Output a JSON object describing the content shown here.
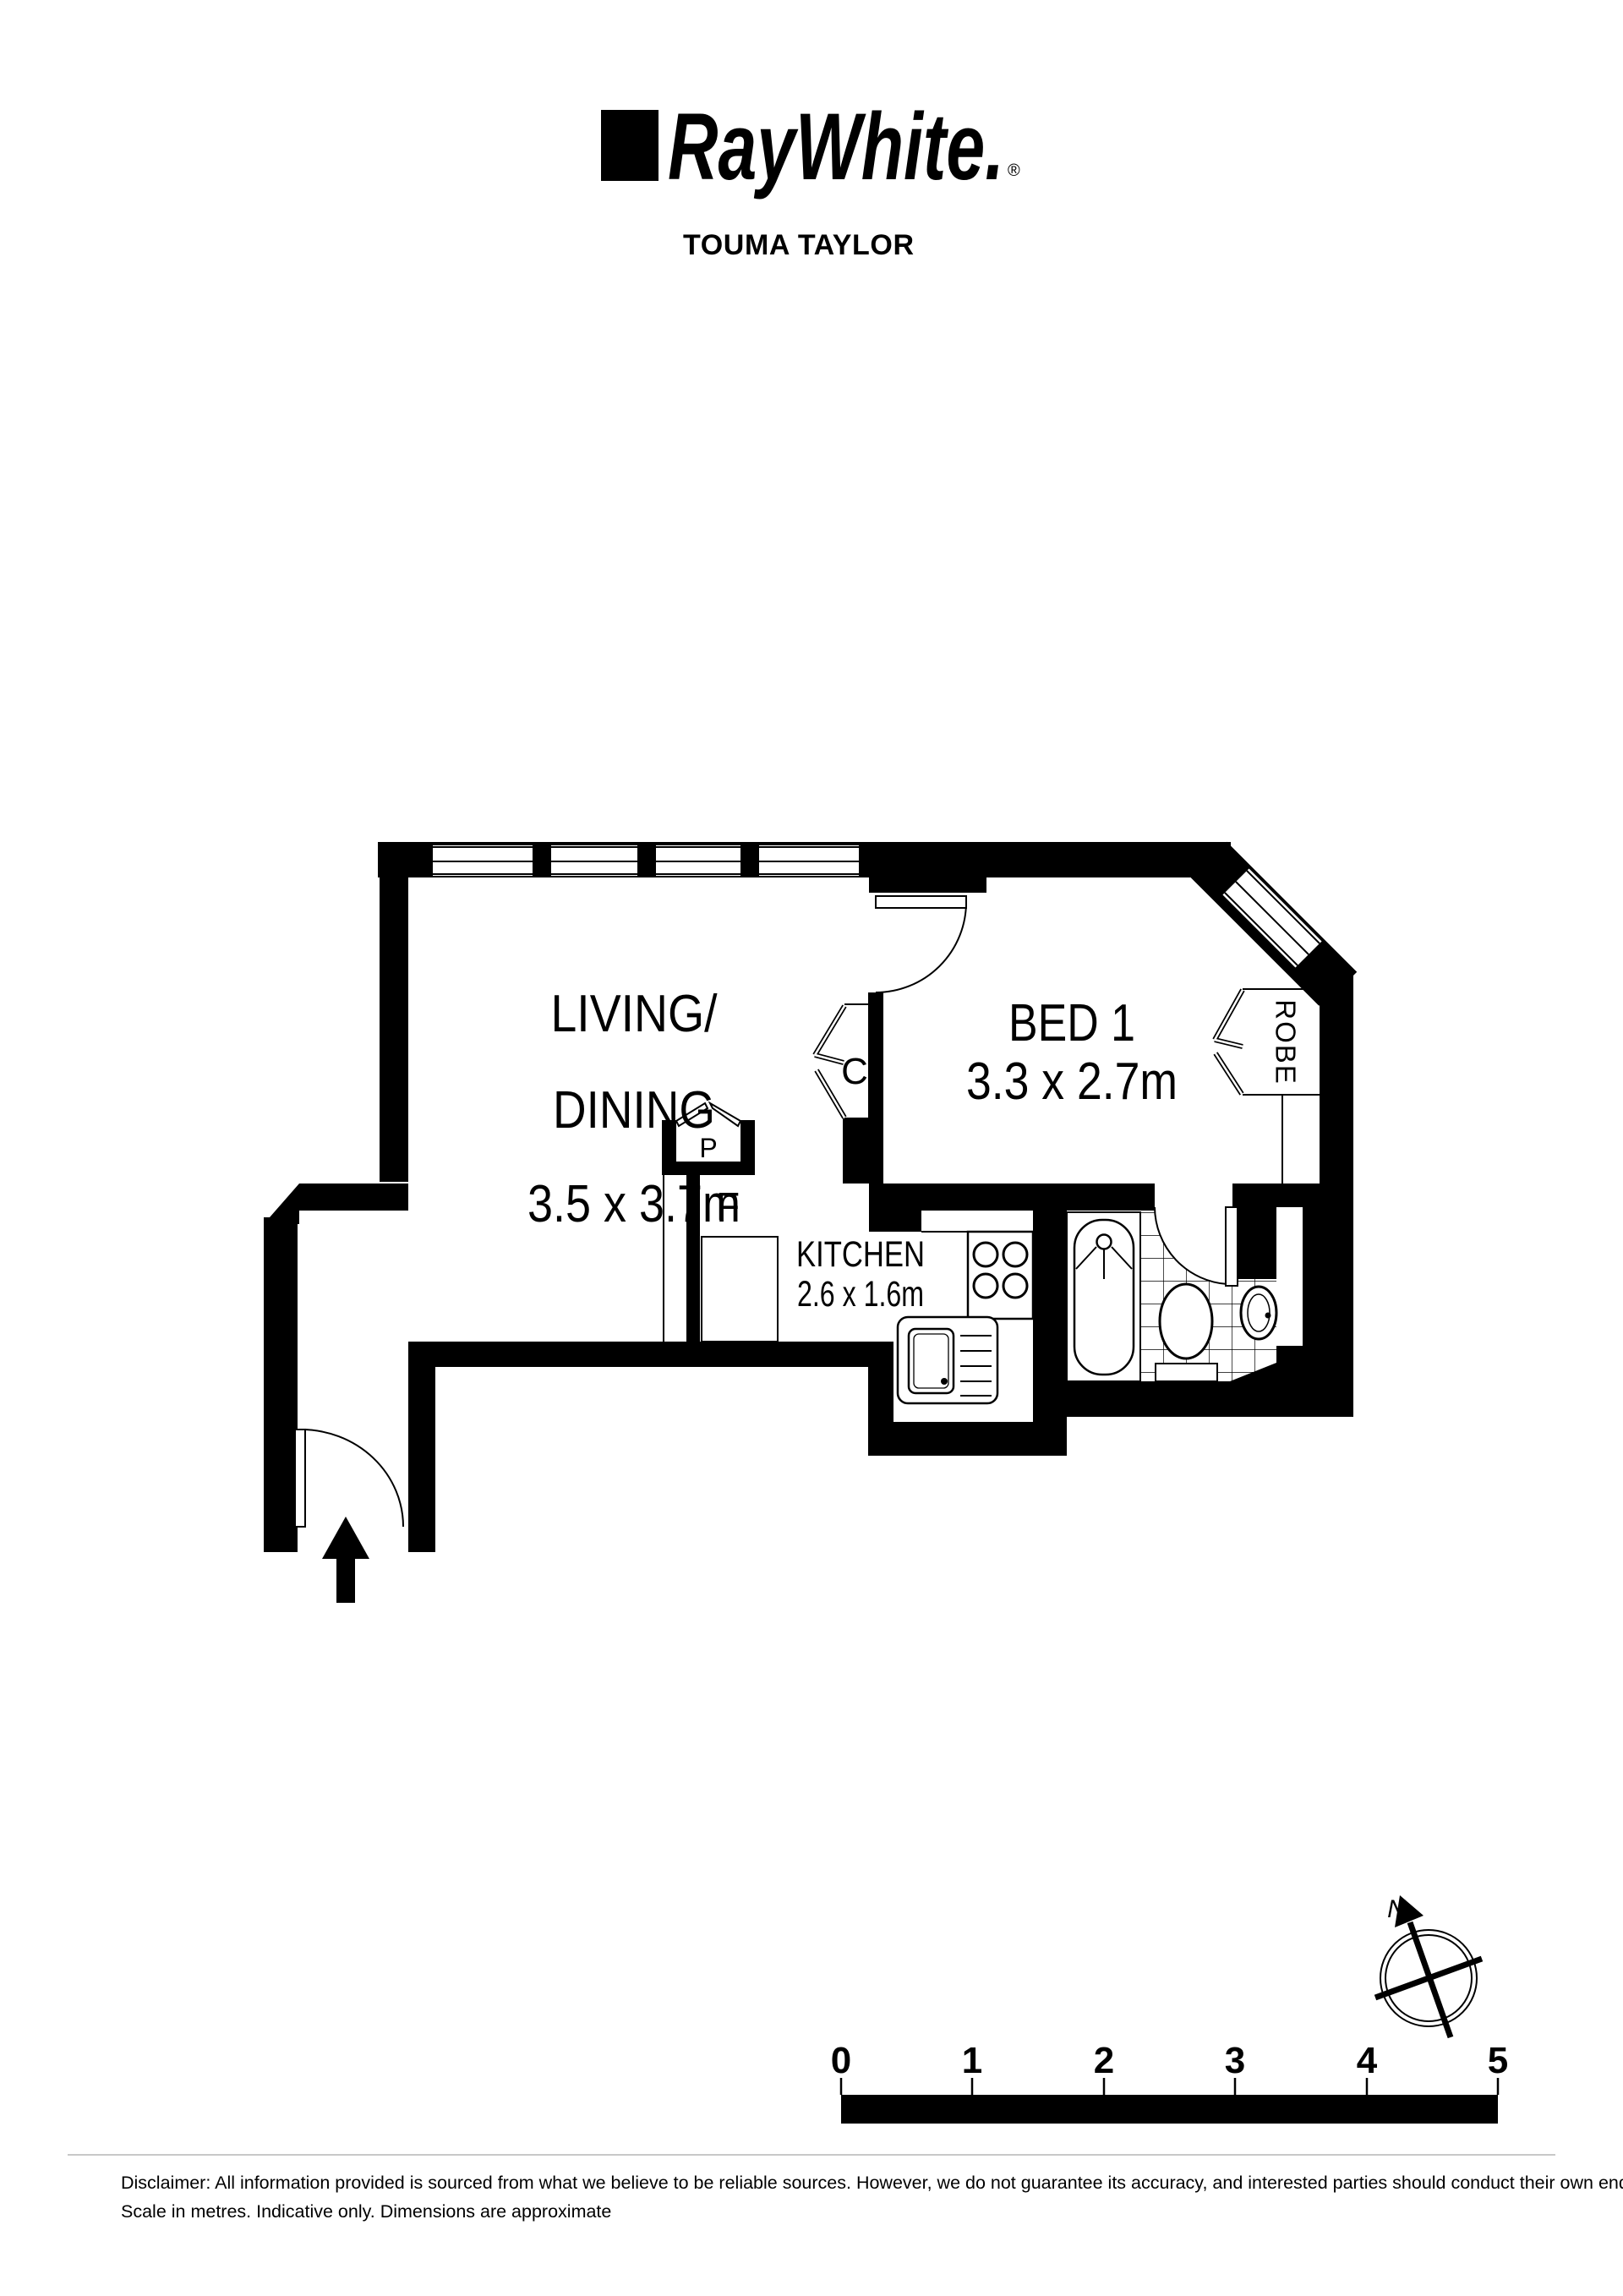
{
  "colors": {
    "ink": "#000000",
    "paper": "#ffffff",
    "hairline": "#c8c8c8"
  },
  "header": {
    "brand": "RayWhite.",
    "registered": "®",
    "office": "TOUMA TAYLOR"
  },
  "rooms": {
    "living": {
      "line1": "LIVING/",
      "line2": "DINING",
      "dims": "3.5 x 3.7m"
    },
    "bed1": {
      "name": "BED 1",
      "dims": "3.3 x 2.7m"
    },
    "kitchen": {
      "name": "KITCHEN",
      "dims": "2.6 x 1.6m"
    }
  },
  "fixtures": {
    "robe": "ROBE",
    "closet": "C",
    "pantry": "P",
    "fridge": "F"
  },
  "compass": {
    "north": "N"
  },
  "scale_bar": {
    "ticks": [
      "0",
      "1",
      "2",
      "3",
      "4",
      "5"
    ]
  },
  "disclaimer": {
    "line1": "Disclaimer: All information provided is sourced from what we believe to be reliable sources. However, we do not guarantee  its accuracy, and interested parties should conduct their own enquiries.",
    "line2": "Scale in metres. Indicative only. Dimensions are approximate"
  }
}
